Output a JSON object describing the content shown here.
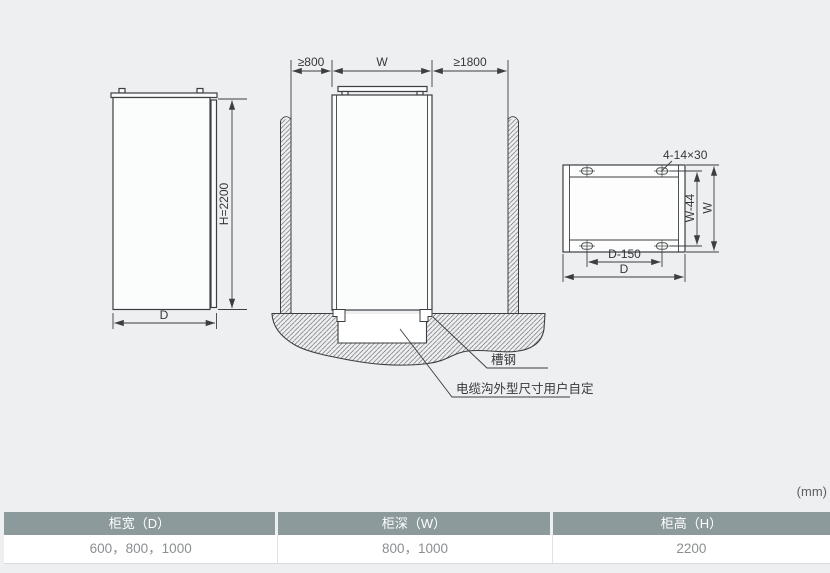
{
  "units_label": "(mm)",
  "drawing": {
    "side_view": {
      "height_label": "H=2200",
      "depth_label": "D"
    },
    "front_view": {
      "left_clearance_label": "≥800",
      "width_label": "W",
      "right_clearance_label": "≥1800",
      "channel_steel_label": "槽钢",
      "cable_trench_label": "电缆沟外型尺寸用户自定"
    },
    "base_view": {
      "holes_label": "4-14×30",
      "inner_width_label": "W-44",
      "width_label": "W",
      "hole_spacing_label": "D-150",
      "depth_label": "D"
    }
  },
  "table": {
    "columns": [
      {
        "header": "柜宽（D）",
        "value": "600，800，1000"
      },
      {
        "header": "柜深（W）",
        "value": "800，1000"
      },
      {
        "header": "柜高（H）",
        "value": "2200"
      }
    ]
  },
  "colors": {
    "background": "#edeff0",
    "line": "#3c3f41",
    "table_header_bg": "#8c9a9c",
    "table_header_text": "#ffffff",
    "table_value_text": "#8b8f90"
  }
}
